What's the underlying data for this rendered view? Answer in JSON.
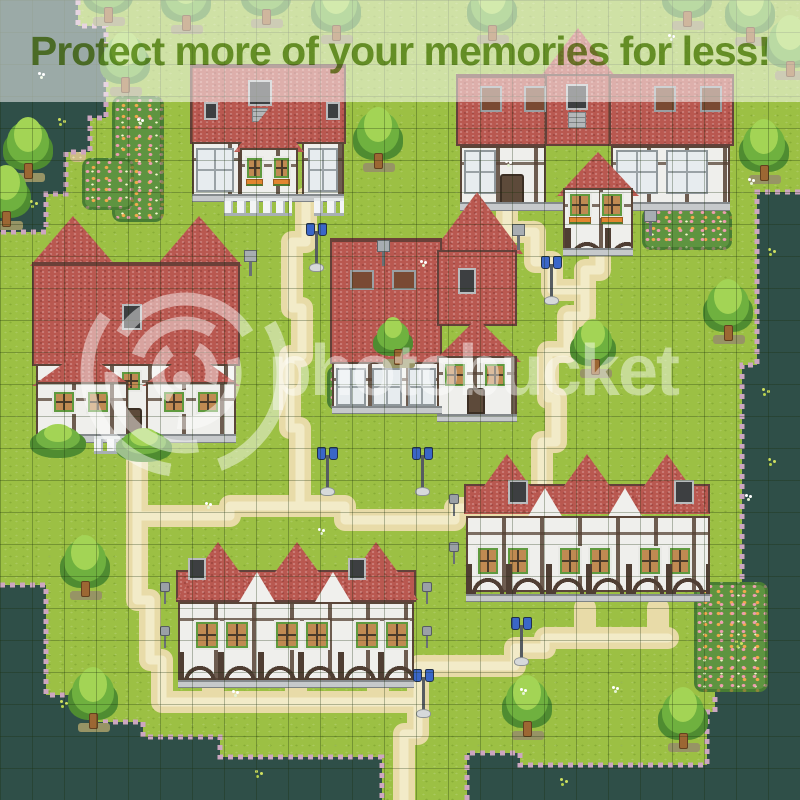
{
  "image_type": "rpg-maker-style village map screenshot with photo-host watermark",
  "watermark": {
    "text": "photobucket",
    "logo": "shutter-spiral-logo",
    "color": "#ffffff",
    "opacity": 0.44
  },
  "banner": {
    "text": "Protect more of your memories for less!",
    "text_color": "#69941d",
    "background": "rgba(255,255,255,0.52)"
  },
  "map": {
    "tile_px": 32,
    "grid_tiles": "25x25",
    "terrain_colors": {
      "grass": "#9cc044",
      "dark_forest": "#2f4f48",
      "path": "#e8dba8",
      "forest_fringe": "#cda6c0",
      "roof_red": "#b95850",
      "wall_white": "#efefec",
      "timber_brown": "#5a4538"
    },
    "features": {
      "houses": 6,
      "row_houses": 2,
      "trees": 20,
      "bushes": 2,
      "street_lamps": 6,
      "sign_posts": 3,
      "wall_lamps": 6,
      "flower_fields": 5,
      "picket_fence": true,
      "winding_paths": true
    }
  }
}
